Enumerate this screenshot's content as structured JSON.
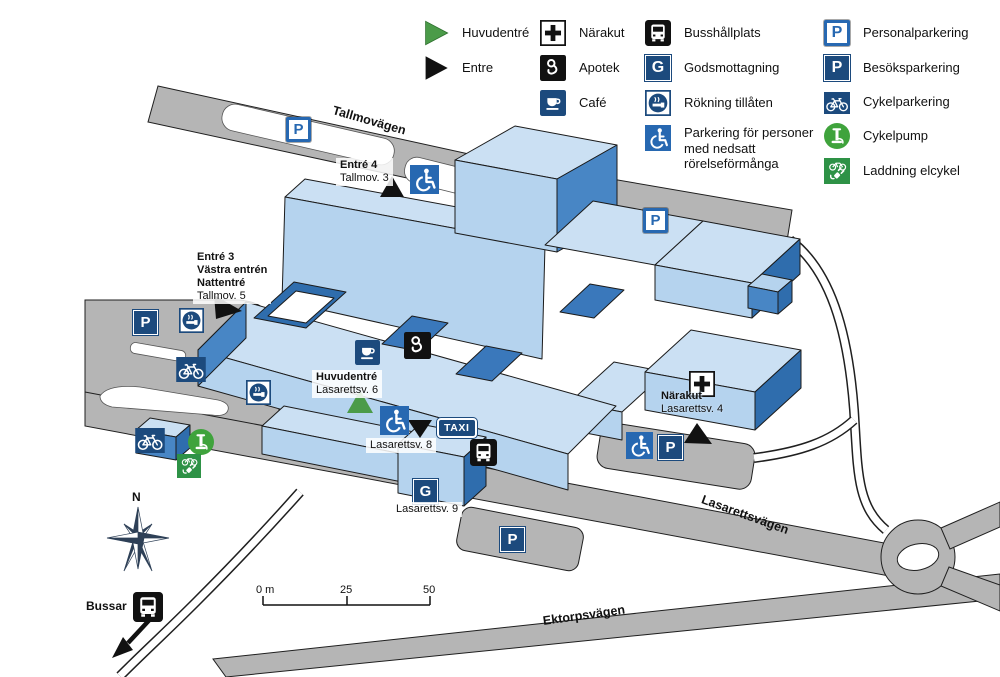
{
  "legend": {
    "items": [
      {
        "icon": "main-entrance-triangle",
        "label": "Huvudentré"
      },
      {
        "icon": "entrance-triangle",
        "label": "Entre"
      },
      {
        "icon": "emergency-clinic",
        "label": "Närakut"
      },
      {
        "icon": "pharmacy",
        "label": "Apotek"
      },
      {
        "icon": "cafe",
        "label": "Café"
      },
      {
        "icon": "bus-stop",
        "label": "Busshållplats"
      },
      {
        "icon": "goods-reception",
        "label": "Godsmottagning"
      },
      {
        "icon": "smoking-allowed",
        "label": "Rökning tillåten"
      },
      {
        "icon": "disabled-parking",
        "label": "Parkering för personer med nedsatt rörelseförmånga"
      },
      {
        "icon": "staff-parking",
        "label": "Personalparkering"
      },
      {
        "icon": "visitor-parking",
        "label": "Besöksparkering"
      },
      {
        "icon": "bicycle-parking",
        "label": "Cykelparkering"
      },
      {
        "icon": "bicycle-pump",
        "label": "Cykelpump"
      },
      {
        "icon": "e-bike-charging",
        "label": "Laddning elcykel"
      }
    ]
  },
  "roads": {
    "tallmovagen": "Tallmovägen",
    "lasarettsvagen": "Lasarettsvägen",
    "ektorpsvagen": "Ektorpsvägen"
  },
  "entrances": {
    "entre4": {
      "lines": [
        "Entré 4",
        "Tallmov. 3"
      ]
    },
    "entre3": {
      "lines": [
        "Entré 3",
        "Västra entrén",
        "Nattentré",
        "Tallmov. 5"
      ]
    },
    "huvudentre": {
      "lines": [
        "Huvudentré",
        "Lasarettsv. 6"
      ]
    },
    "lasarettsv8": {
      "lines": [
        "Lasarettsv. 8"
      ]
    },
    "lasarettsv9": {
      "lines": [
        "Lasarettsv. 9"
      ]
    },
    "narakut": {
      "lines": [
        "Närakut",
        "Lasarettsv. 4"
      ]
    }
  },
  "scale": {
    "labels": [
      "0 m",
      "25",
      "50"
    ]
  },
  "misc": {
    "bussar": "Bussar",
    "north": "N",
    "taxi": "TAXI",
    "goods_letter": "G",
    "parking_letter": "P"
  },
  "colors": {
    "road_gray": "#b5b5b5",
    "building_roof": "#cbe0f3",
    "building_front": "#b5d3ee",
    "building_side": "#4886c5",
    "building_dark": "#2f6dad",
    "navy_icon": "#1c4a7d",
    "accessible_blue": "#2768b1",
    "entrance_green": "#4b9b49",
    "pump_green": "#3fa33c",
    "charge_green": "#2e9246"
  }
}
